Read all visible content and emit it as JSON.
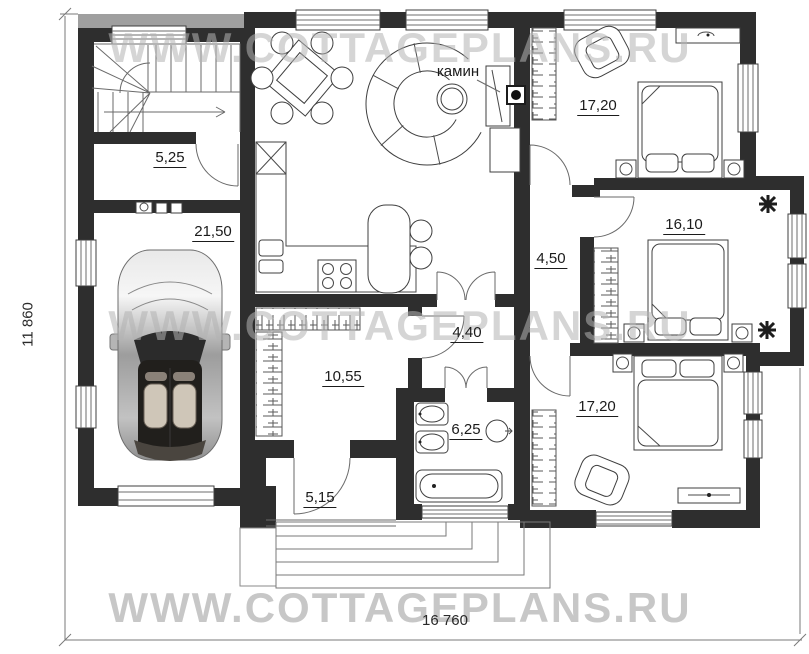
{
  "plan": {
    "watermark_text": "WWW.COTTAGEPLANS.RU",
    "fireplace_label": "камин",
    "dimensions": {
      "horizontal": "16 760",
      "vertical": "11 860"
    },
    "rooms": [
      {
        "id": "boiler-room",
        "area_label": "5,25"
      },
      {
        "id": "garage",
        "area_label": "21,50"
      },
      {
        "id": "bedroom-top",
        "area_label": "17,20"
      },
      {
        "id": "bedroom-middle",
        "area_label": "16,10"
      },
      {
        "id": "corridor",
        "area_label": "4,50"
      },
      {
        "id": "hallway",
        "area_label": "4,40"
      },
      {
        "id": "wardrobe-room",
        "area_label": "10,55"
      },
      {
        "id": "bathroom",
        "area_label": "6,25"
      },
      {
        "id": "vestibule",
        "area_label": "5,15"
      },
      {
        "id": "bedroom-bottom",
        "area_label": "17,20"
      }
    ],
    "colors": {
      "wall": "#2e2e2e",
      "watermark": "#b3b3b3",
      "accent_line": "#4a4a4a"
    }
  }
}
